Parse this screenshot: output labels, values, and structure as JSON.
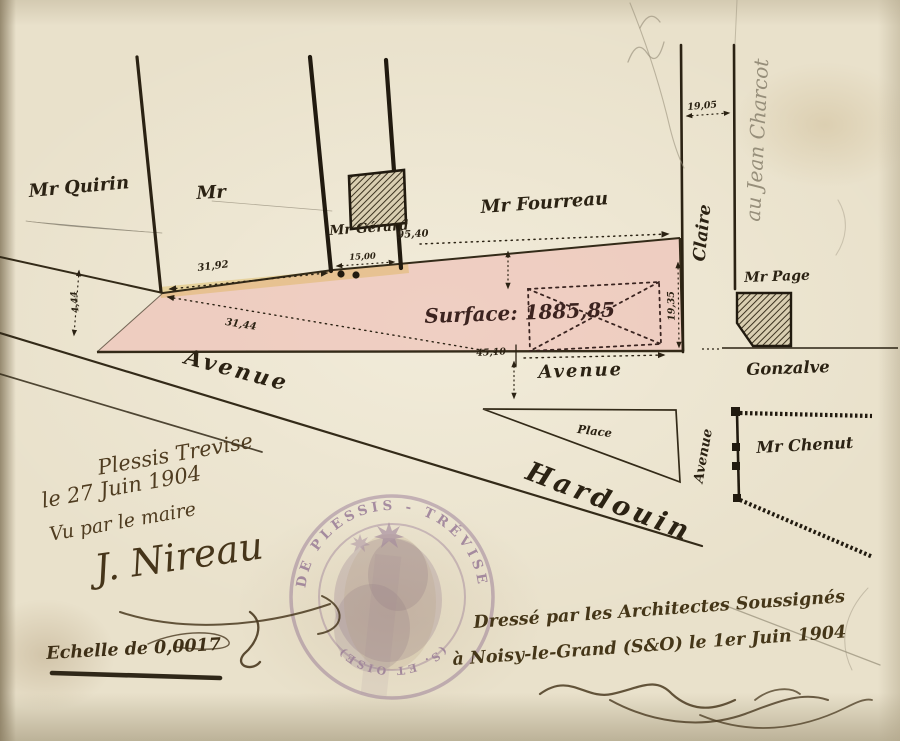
{
  "plan": {
    "owners": {
      "quirin": "Mr Quirin",
      "anon": "Mr",
      "gerard": "Mr Gérard",
      "fourreau": "Mr Fourreau",
      "page": "Mr Page",
      "chenut": "Mr Chenut"
    },
    "streets": {
      "claire": "Claire",
      "gonzalve": "Gonzalve",
      "avenue_left": "Avenue",
      "avenue_mid": "Avenue",
      "avenue_vert": "Avenue",
      "hardouin": "Hardouin",
      "place": "Place"
    },
    "surface_label": "Surface: 1885,85",
    "measurements": {
      "m95": "95,40",
      "m3192": "31,92",
      "m3144": "31,44",
      "m1500": "15,00",
      "m1905": "19,05",
      "m1935": "19,35",
      "m444": "4,44",
      "m4510": "45,10"
    },
    "pencil_note": "au Jean Charcot"
  },
  "annotations": {
    "approval": {
      "place_date": "Plessis Trevise",
      "date": "le 27 Juin 1904",
      "vu": "Vu par le maire",
      "signature": "J. Nireau"
    },
    "scale": "Echelle de 0,0017",
    "attestation": {
      "line1": "Dressé par les Architectes Soussignés",
      "line2": "à Noisy-le-Grand (S&O) le 1er Juin 1904"
    },
    "stamp": {
      "top": "DE PLESSIS - TRÉVISE",
      "bottom": "(S. ET OISE)"
    }
  },
  "colors": {
    "paper": "#e9e1cb",
    "ink": "#2b2213",
    "sepia": "#4f3c20",
    "pink": "#efc3ba",
    "stamp": "#7b5683",
    "pencil": "#8e8672"
  }
}
